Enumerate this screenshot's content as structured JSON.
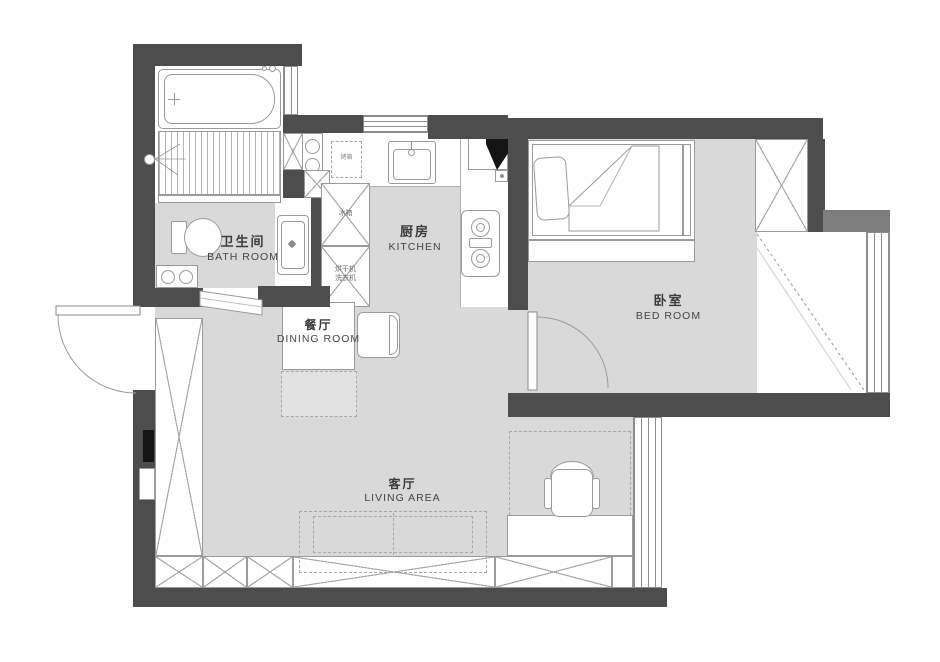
{
  "title": "apartment-floor-plan",
  "rooms": {
    "bathroom": {
      "zh": "卫生间",
      "en": "BATH  ROOM"
    },
    "kitchen": {
      "zh": "厨房",
      "en": "KITCHEN"
    },
    "dining": {
      "zh": "餐厅",
      "en": "DINING ROOM"
    },
    "bedroom": {
      "zh": "卧室",
      "en": "BED  ROOM"
    },
    "living": {
      "zh": "客厅",
      "en": "LIVING  AREA"
    }
  },
  "appliances": {
    "fridge": "冰箱",
    "dryer": "烘干机",
    "washer": "洗衣机",
    "oven": "烤箱"
  },
  "colors": {
    "wall": "#4d4d4d",
    "wall_light": "#7e7e7e",
    "floor": "#d9d9d9",
    "line": "#9b9b9b"
  }
}
